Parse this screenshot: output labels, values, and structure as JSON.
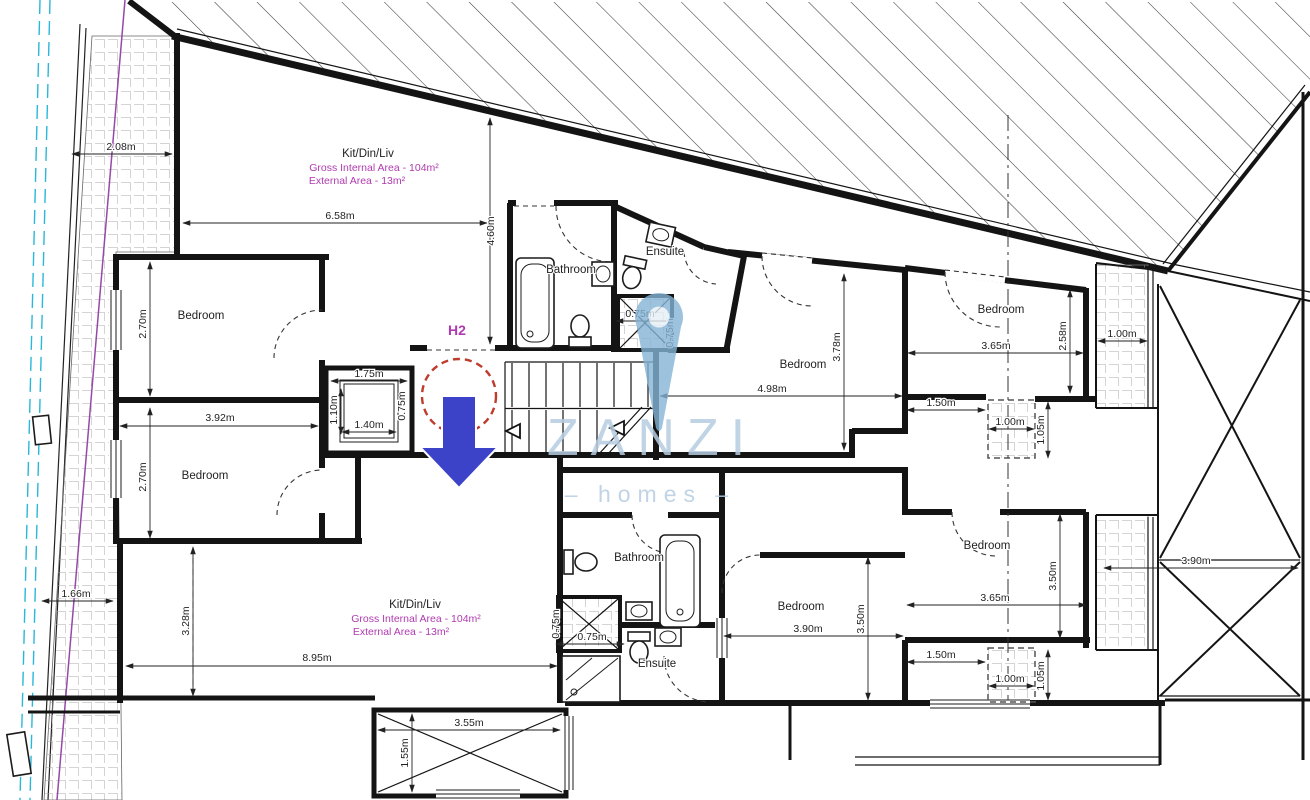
{
  "plan": {
    "unit": "H2"
  },
  "watermark": {
    "brand": "ZANZI",
    "tagline": "– homes –"
  },
  "colors": {
    "wall": "#141414",
    "purple_text": "#b03ab0",
    "marker_red": "#bf3b2b",
    "arrow_blue": "#3d43c8",
    "watermark_blue": "#b6cde1",
    "boundary_cyan": "#2ab7d9",
    "boundary_purple": "#9549a8"
  },
  "rooms": {
    "upper": {
      "kit": "Kit/Din/Liv",
      "gross": "Gross Internal Area - 104m²",
      "external": "External Area - 13m²",
      "bathroom": "Bathroom",
      "ensuite": "Ensuite",
      "bedroom1": "Bedroom",
      "bedroom2": "Bedroom",
      "bedroom_mid": "Bedroom",
      "bedroom_right": "Bedroom"
    },
    "lower": {
      "kit": "Kit/Din/Liv",
      "gross": "Gross Internal Area - 104m²",
      "external": "External Area - 13m²",
      "bathroom": "Bathroom",
      "ensuite": "Ensuite",
      "bedroom_mid": "Bedroom",
      "bedroom_right": "Bedroom"
    }
  },
  "dims": {
    "d208": "2.08m",
    "d658": "6.58m",
    "d460": "4.60m",
    "d392": "3.92m",
    "d270a": "2.70m",
    "d270b": "2.70m",
    "d175": "1.75m",
    "d110": "1.10m",
    "d140": "1.40m",
    "d075_lift": "0.75m",
    "d075_up_h": "0.75m",
    "d075_up_v": "0.75m",
    "d498": "4.98m",
    "d378": "3.78m",
    "d365_tr": "3.65m",
    "d258": "2.58m",
    "d100_tr": "1.00m",
    "d150_up": "1.50m",
    "d100_mid": "1.00m",
    "d105_mid": "1.05m",
    "d895": "8.95m",
    "d328": "3.28m",
    "d166": "1.66m",
    "d075_low_h": "0.75m",
    "d075_low_v": "0.75m",
    "d390_bm": "3.90m",
    "d350_bm": "3.50m",
    "d365_br": "3.65m",
    "d350_br": "3.50m",
    "d150_low": "1.50m",
    "d100_low": "1.00m",
    "d105_low": "1.05m",
    "d390_right": "3.90m",
    "d355": "3.55m",
    "d155": "1.55m"
  }
}
